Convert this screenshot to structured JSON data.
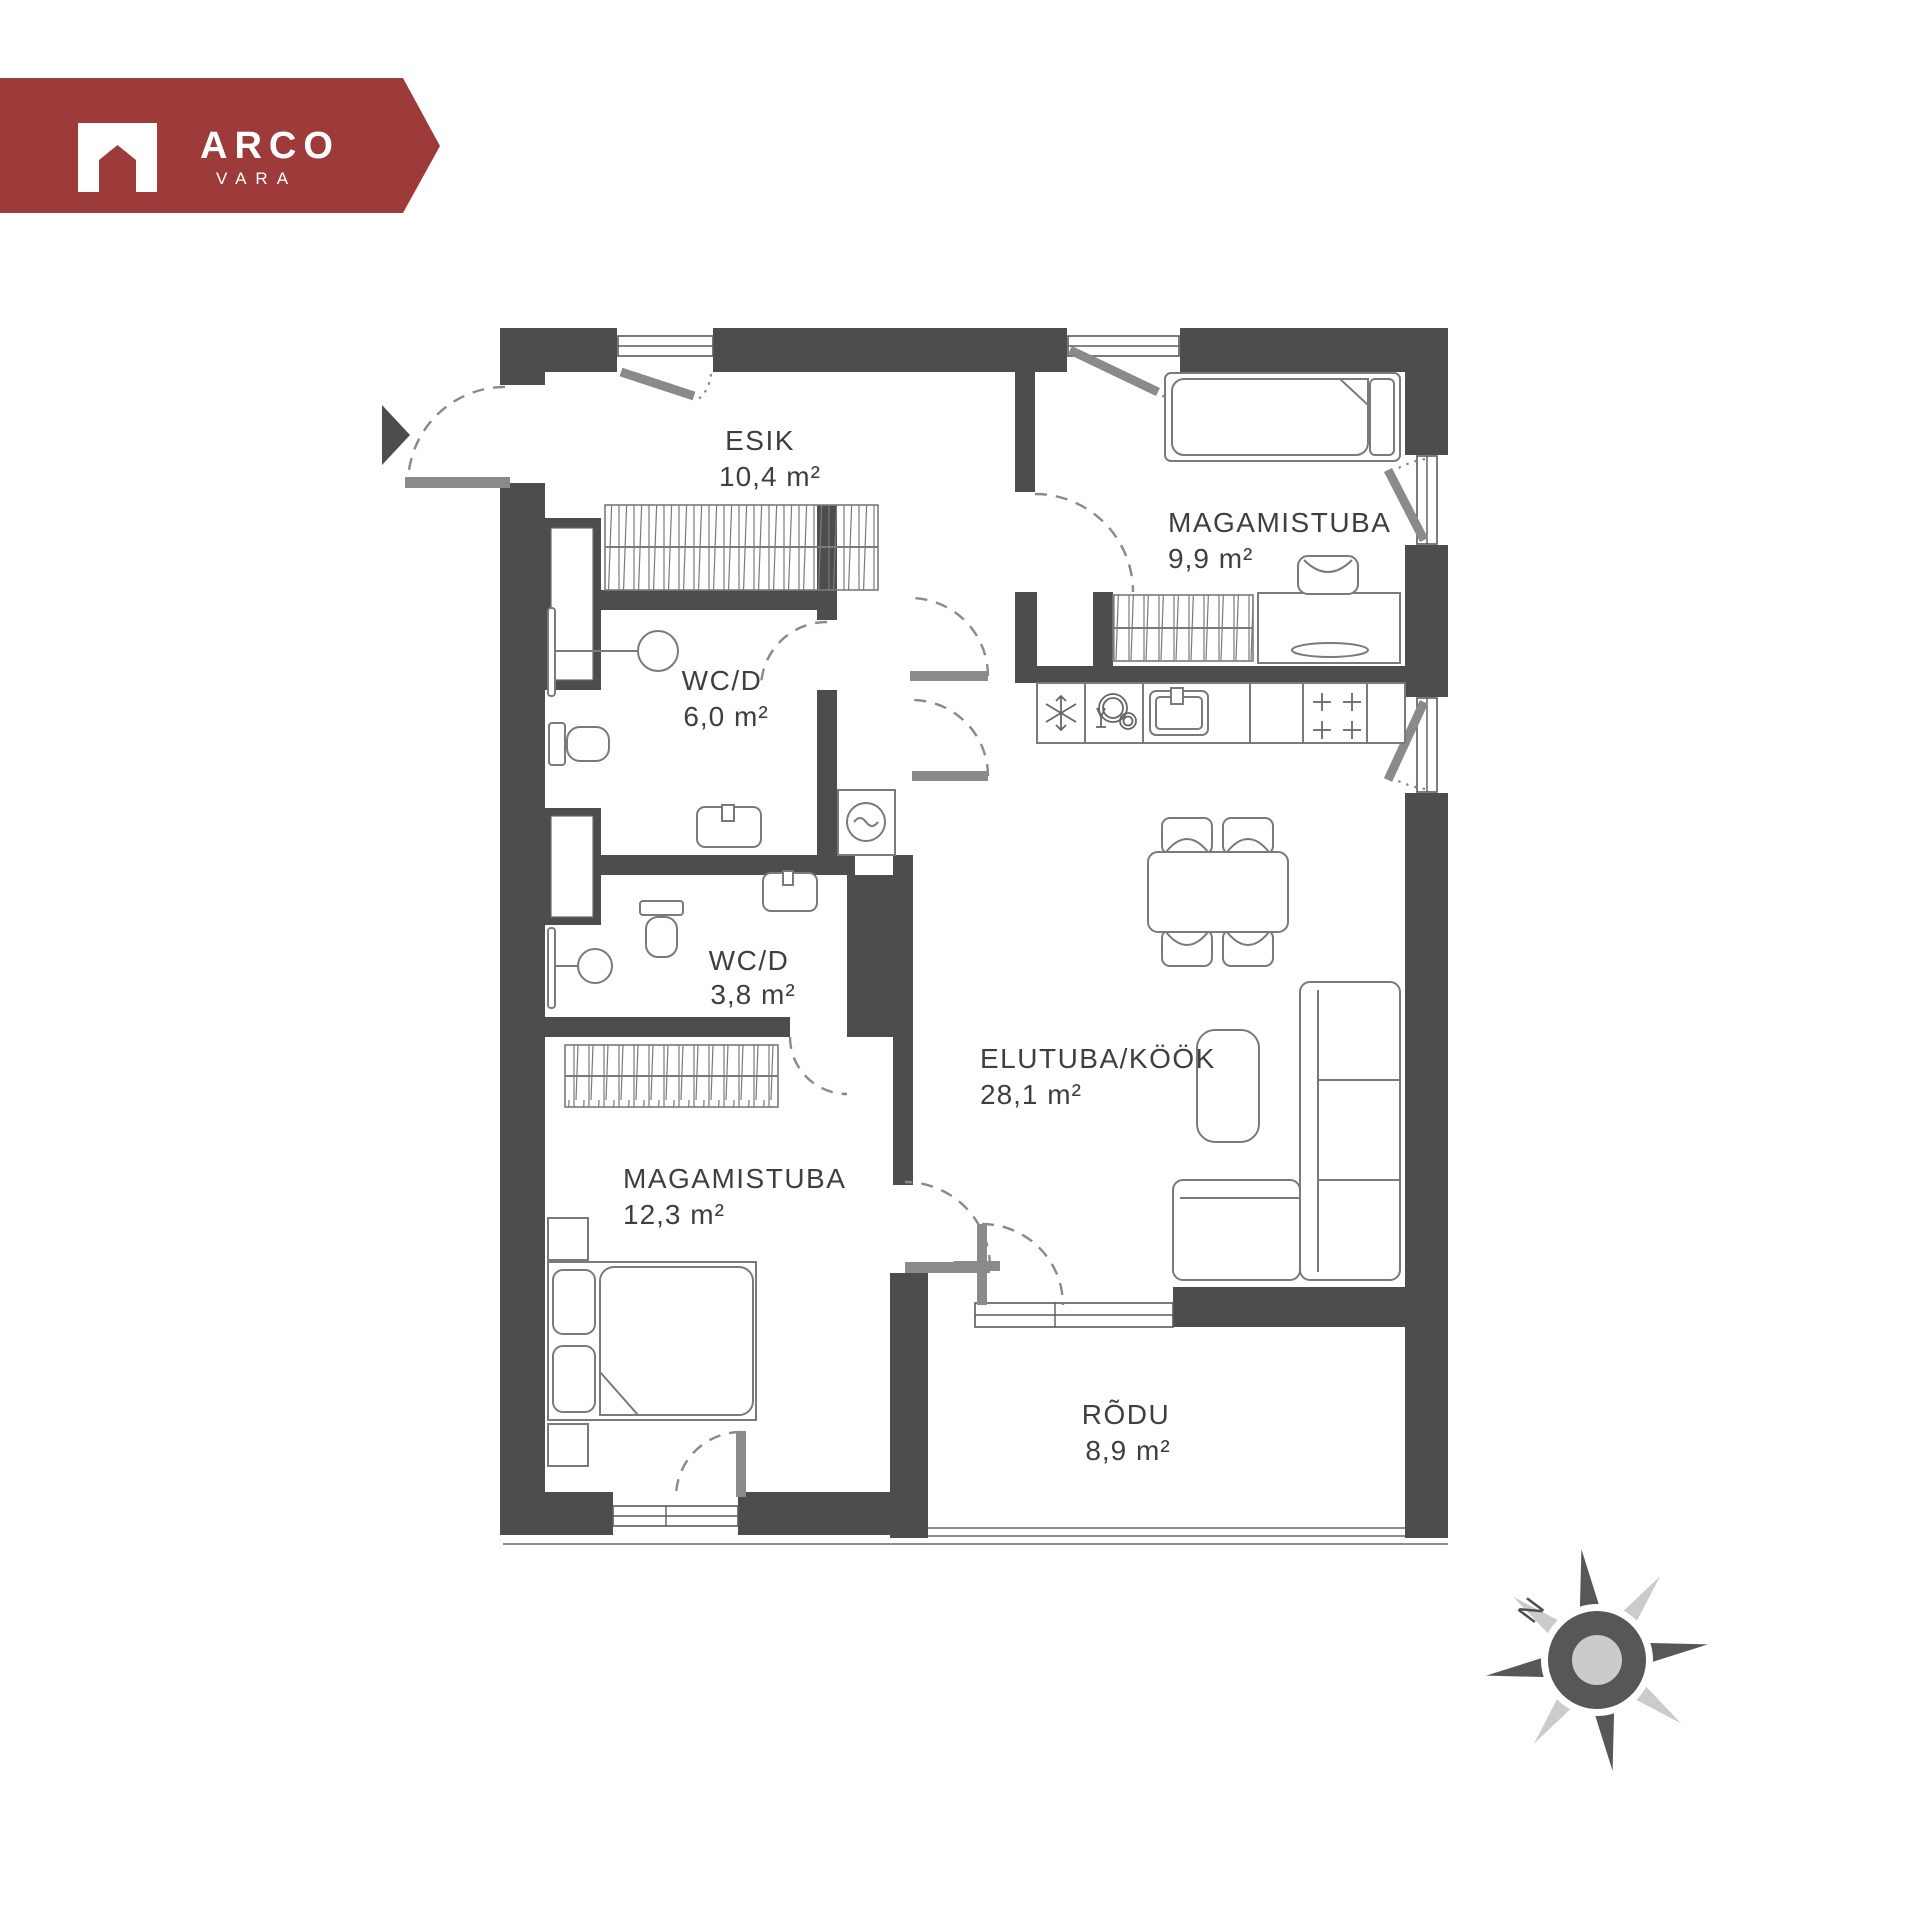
{
  "logo": {
    "brand": "ARCO",
    "sub": "VARA",
    "brand_color": "#9d3b3b"
  },
  "compass": {
    "north_label": "N",
    "dark_color": "#575757",
    "light_color": "#cbcbcb"
  },
  "plan": {
    "wall_color": "#4d4d4d",
    "door_color": "#8a8a8a",
    "furniture_line_color": "#7a7a7a",
    "text_color": "#3f3f3f"
  },
  "rooms": [
    {
      "id": "esik",
      "name": "ESIK",
      "area": "10,4 m²"
    },
    {
      "id": "magamistuba1",
      "name": "MAGAMISTUBA",
      "area": "9,9 m²"
    },
    {
      "id": "wcd1",
      "name": "WC/D",
      "area": "6,0 m²"
    },
    {
      "id": "wcd2",
      "name": "WC/D",
      "area": "3,8 m²"
    },
    {
      "id": "elutuba",
      "name": "ELUTUBA/KÖÖK",
      "area": "28,1 m²"
    },
    {
      "id": "magamistuba2",
      "name": "MAGAMISTUBA",
      "area": "12,3 m²"
    },
    {
      "id": "rodu",
      "name": "RÕDU",
      "area": "8,9 m²"
    }
  ]
}
